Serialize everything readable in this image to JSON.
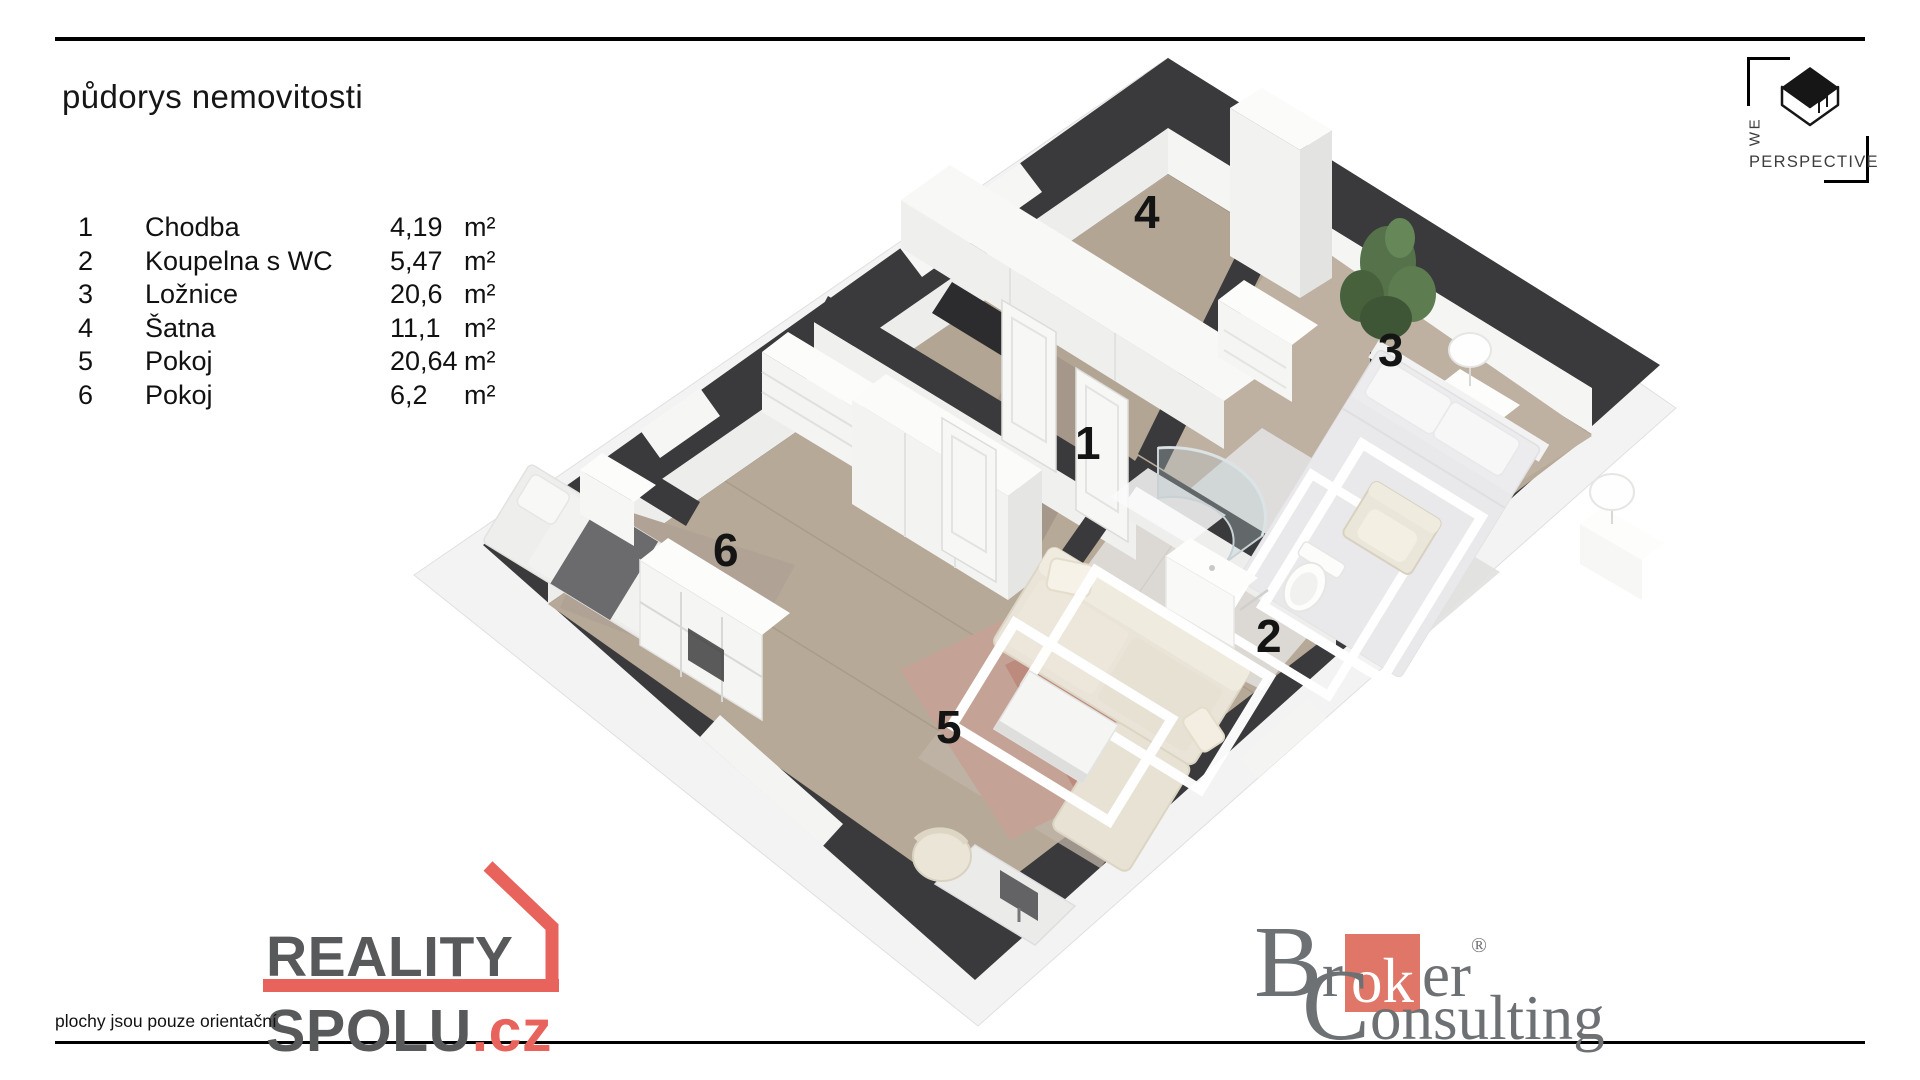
{
  "header": {
    "title": "půdorys nemovitosti"
  },
  "legend": {
    "rows": [
      {
        "num": "1",
        "name": "Chodba",
        "area": "4,19",
        "unit": "m²"
      },
      {
        "num": "2",
        "name": "Koupelna s WC",
        "area": "5,47",
        "unit": "m²"
      },
      {
        "num": "3",
        "name": "Ložnice",
        "area": "20,6",
        "unit": "m²"
      },
      {
        "num": "4",
        "name": "Šatna",
        "area": "11,1",
        "unit": "m²"
      },
      {
        "num": "5",
        "name": "Pokoj",
        "area": "20,64",
        "unit": "m²"
      },
      {
        "num": "6",
        "name": "Pokoj",
        "area": "6,2",
        "unit": "m²"
      }
    ]
  },
  "footer": {
    "disclaimer": "plochy jsou pouze orientační"
  },
  "logos": {
    "reality_spolu": {
      "word1": "REALITY",
      "word2": "SPOLU",
      "tld": ".cz"
    },
    "broker": {
      "pre": "Br",
      "mid": "ok",
      "post": "er",
      "reg": "®",
      "line2": "Consulting"
    },
    "we_perspective": {
      "we": "WE",
      "perspective": "PERSPECTIVE"
    }
  },
  "palette": {
    "accent_red": "#e8635c",
    "broker_salmon": "#df7668",
    "logo_gray": "#58595b",
    "broker_gray": "#6e7174",
    "wall_dark": "#3a3a3c",
    "floor_wood": "#b6a998",
    "bath_tile": "#dcd9d5",
    "slab_white": "#f3f3f3"
  }
}
